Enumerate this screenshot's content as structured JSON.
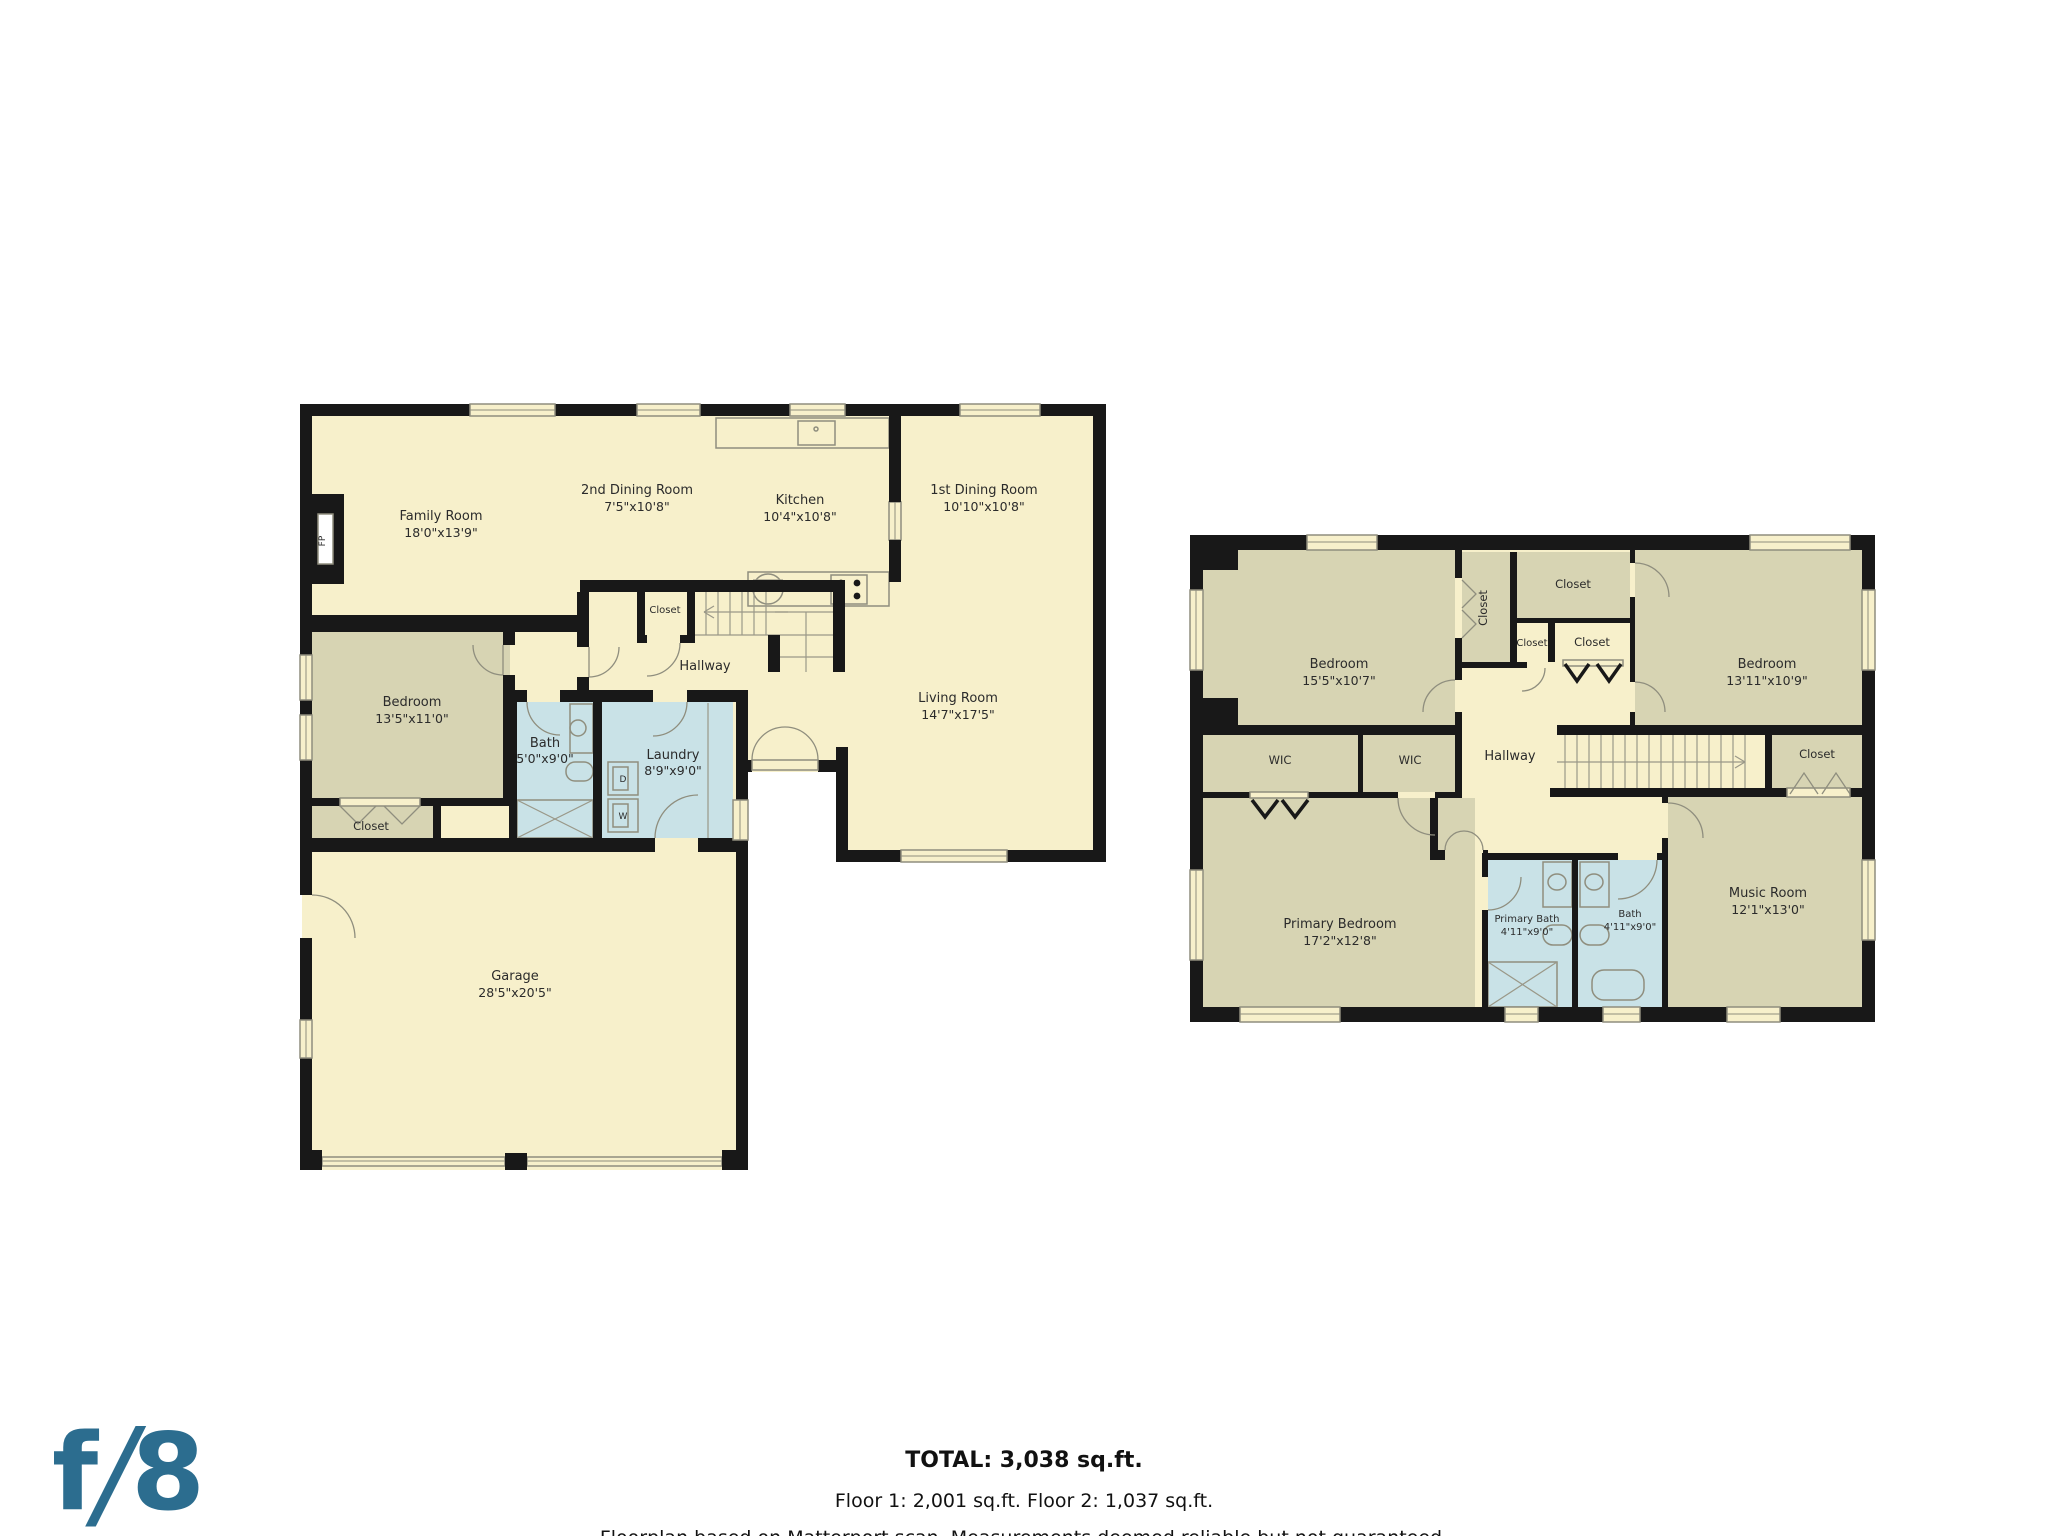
{
  "colors": {
    "wall": "#181818",
    "room_cream": "#f7f0cb",
    "room_olive": "#d7d4b3",
    "room_blue": "#c9e2e7",
    "logo_blue": "#2c6d8f"
  },
  "branding": {
    "logo_text_f": "f",
    "logo_text_slash": "/",
    "logo_text_8": "8"
  },
  "footer": {
    "total": "TOTAL: 3,038 sq.ft.",
    "floors": "Floor 1: 2,001 sq.ft. Floor 2: 1,037 sq.ft.",
    "disclaimer": "Floorplan based on Matterport scan. Measurements deemed reliable but not guaranteed."
  },
  "floor1": {
    "rooms": {
      "family": {
        "name": "Family Room",
        "dims": "18'0\"x13'9\""
      },
      "dining2": {
        "name": "2nd Dining Room",
        "dims": "7'5\"x10'8\""
      },
      "kitchen": {
        "name": "Kitchen",
        "dims": "10'4\"x10'8\""
      },
      "dining1": {
        "name": "1st Dining Room",
        "dims": "10'10\"x10'8\""
      },
      "living": {
        "name": "Living Room",
        "dims": "14'7\"x17'5\""
      },
      "bedroom": {
        "name": "Bedroom",
        "dims": "13'5\"x11'0\""
      },
      "bath": {
        "name": "Bath",
        "dims": "5'0\"x9'0\""
      },
      "laundry": {
        "name": "Laundry",
        "dims": "8'9\"x9'0\""
      },
      "hallway": {
        "name": "Hallway"
      },
      "closet_hall": {
        "name": "Closet"
      },
      "closet_bedroom": {
        "name": "Closet"
      },
      "garage": {
        "name": "Garage",
        "dims": "28'5\"x20'5\""
      }
    },
    "fixtures": {
      "dryer": "D",
      "washer": "W",
      "fireplace": "FP"
    }
  },
  "floor2": {
    "rooms": {
      "bedroom_left": {
        "name": "Bedroom",
        "dims": "15'5\"x10'7\""
      },
      "closet_tall": {
        "name": "Closet"
      },
      "closet_top": {
        "name": "Closet"
      },
      "closet_small_left": {
        "name": "Closet"
      },
      "closet_small_right": {
        "name": "Closet"
      },
      "bedroom_right": {
        "name": "Bedroom",
        "dims": "13'11\"x10'9\""
      },
      "wic_left": {
        "name": "WIC"
      },
      "wic_mid": {
        "name": "WIC"
      },
      "hallway": {
        "name": "Hallway"
      },
      "closet_right": {
        "name": "Closet"
      },
      "primary_bedroom": {
        "name": "Primary Bedroom",
        "dims": "17'2\"x12'8\""
      },
      "primary_bath": {
        "name": "Primary Bath",
        "dims": "4'11\"x9'0\""
      },
      "bath": {
        "name": "Bath",
        "dims": "4'11\"x9'0\""
      },
      "music": {
        "name": "Music Room",
        "dims": "12'1\"x13'0\""
      }
    }
  }
}
